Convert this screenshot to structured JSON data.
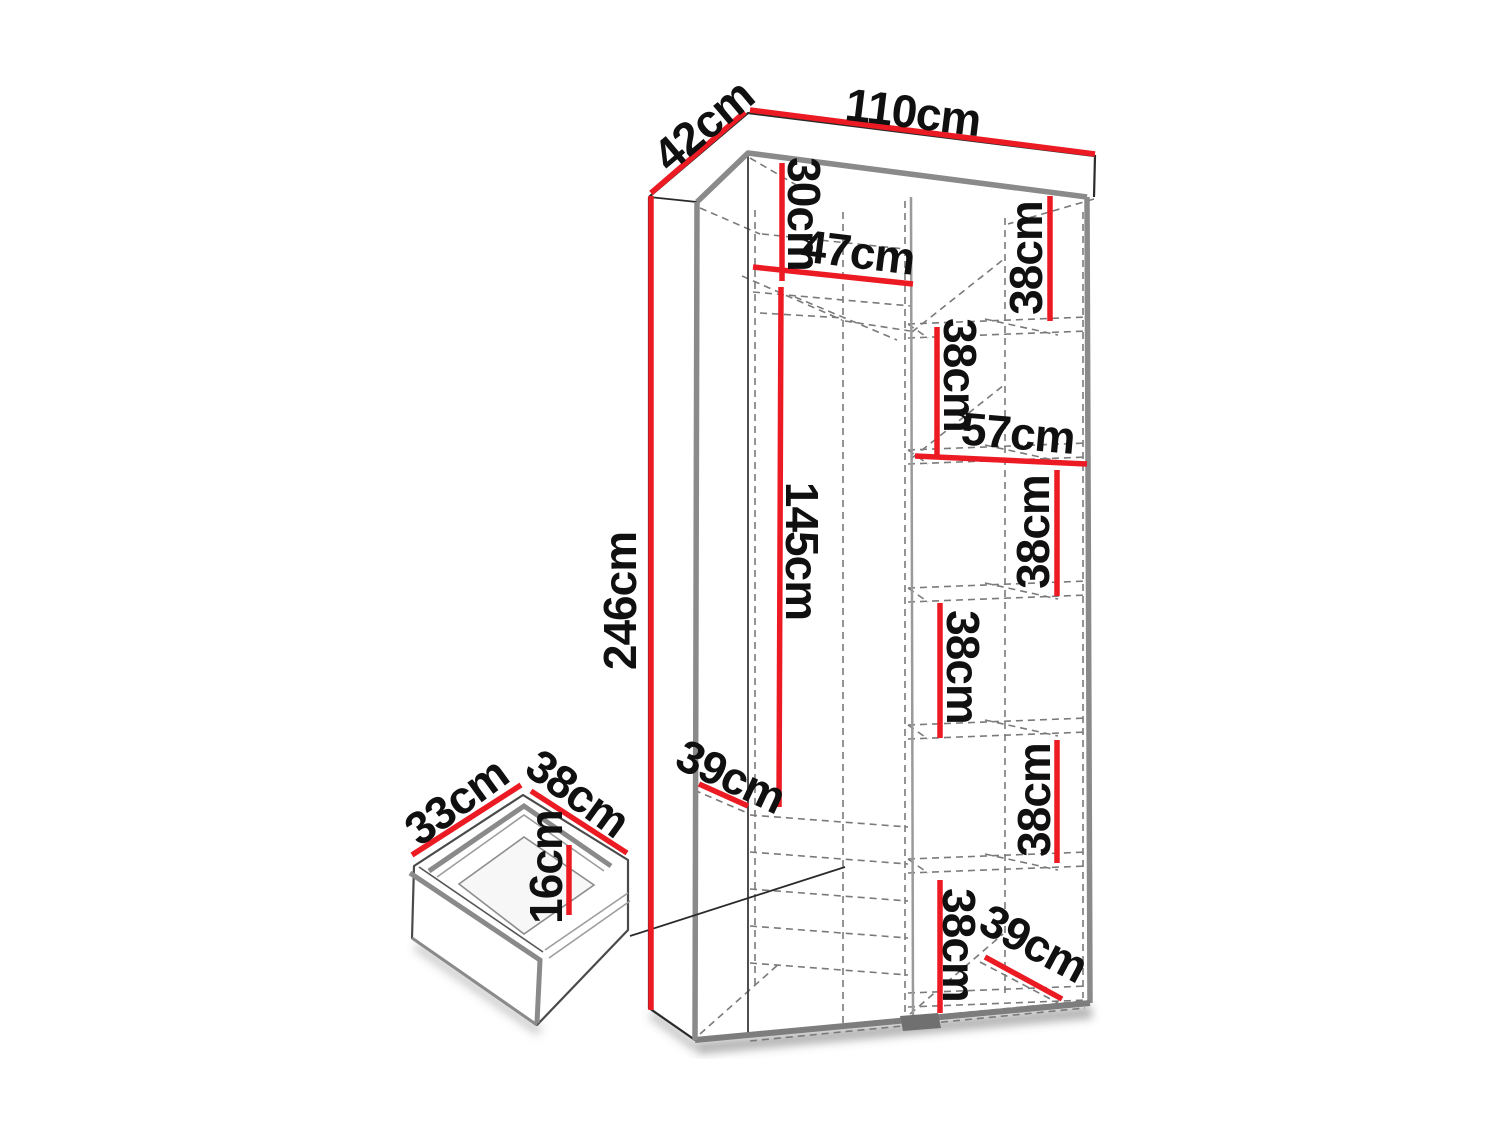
{
  "diagram": {
    "kind": "furniture-dimension-diagram",
    "subject": "tall wardrobe with shelves, hanging space and detail view of a drawer",
    "colors": {
      "dimension_line": "#ec1b23",
      "body_edge": "#8a8a8a",
      "outline": "#2a2a2a",
      "hidden_line": "#7a7a7a",
      "label_text": "#101010",
      "background": "#ffffff"
    }
  },
  "labels": {
    "d42": "42cm",
    "d110": "110cm",
    "d246": "246cm",
    "d30": "30cm",
    "d47": "47cm",
    "d38_1": "38cm",
    "d38_2": "38cm",
    "d57": "57cm",
    "d38_3": "38cm",
    "d38_4": "38cm",
    "d38_5": "38cm",
    "d38_6": "38cm",
    "d145": "145cm",
    "d39_left": "39cm",
    "d39_right": "39cm",
    "d33": "33cm",
    "d38_drawer": "38cm",
    "d16": "16cm"
  }
}
